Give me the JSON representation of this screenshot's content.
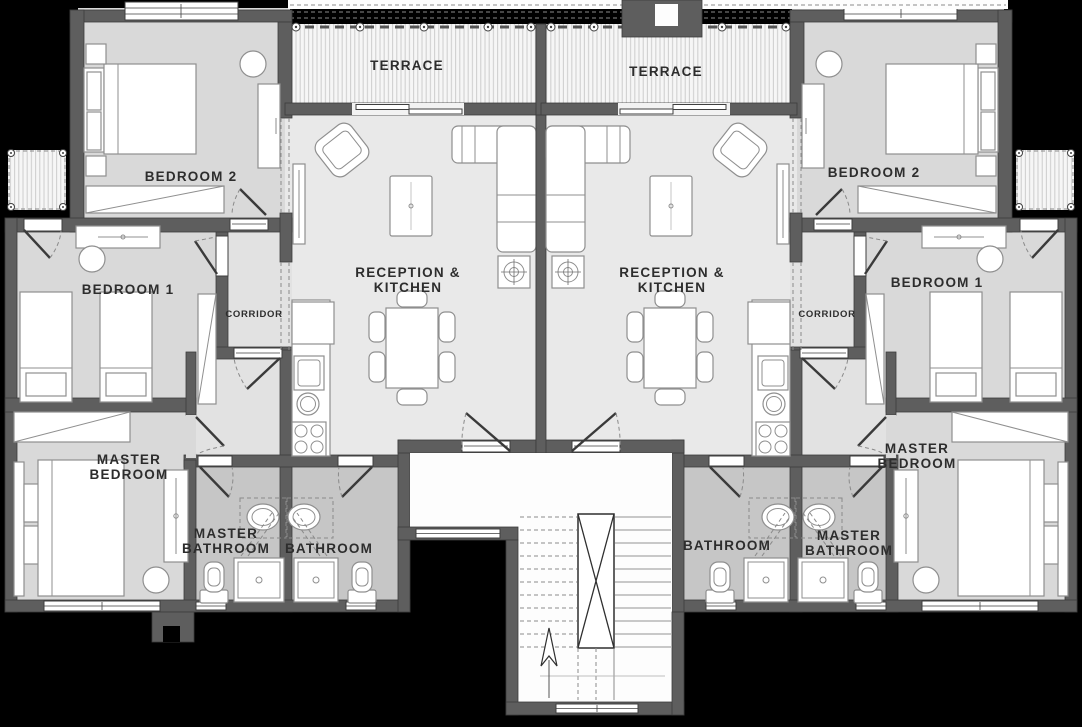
{
  "plan": {
    "colors": {
      "background": "#000000",
      "wall": "#5e5e5e",
      "room": "#e9e9e9",
      "bedroom": "#d9d9d9",
      "bath": "#c6c6c6",
      "hall": "#e2e2e2",
      "line": "#8f8f8f",
      "label": "#2d2d2d"
    },
    "left_unit": {
      "terrace": "TERRACE",
      "bedroom2": "BEDROOM 2",
      "bedroom1": "BEDROOM 1",
      "corridor": "CORRIDOR",
      "reception_line1": "RECEPTION &",
      "reception_line2": "KITCHEN",
      "master_bedroom_line1": "MASTER",
      "master_bedroom_line2": "BEDROOM",
      "master_bathroom_line1": "MASTER",
      "master_bathroom_line2": "BATHROOM",
      "bathroom": "BATHROOM"
    },
    "right_unit": {
      "terrace": "TERRACE",
      "bedroom2": "BEDROOM 2",
      "bedroom1": "BEDROOM 1",
      "corridor": "CORRIDOR",
      "reception_line1": "RECEPTION &",
      "reception_line2": "KITCHEN",
      "master_bedroom_line1": "MASTER",
      "master_bedroom_line2": "BEDROOM",
      "master_bathroom_line1": "MASTER",
      "master_bathroom_line2": "BATHROOM",
      "bathroom": "BATHROOM"
    }
  }
}
